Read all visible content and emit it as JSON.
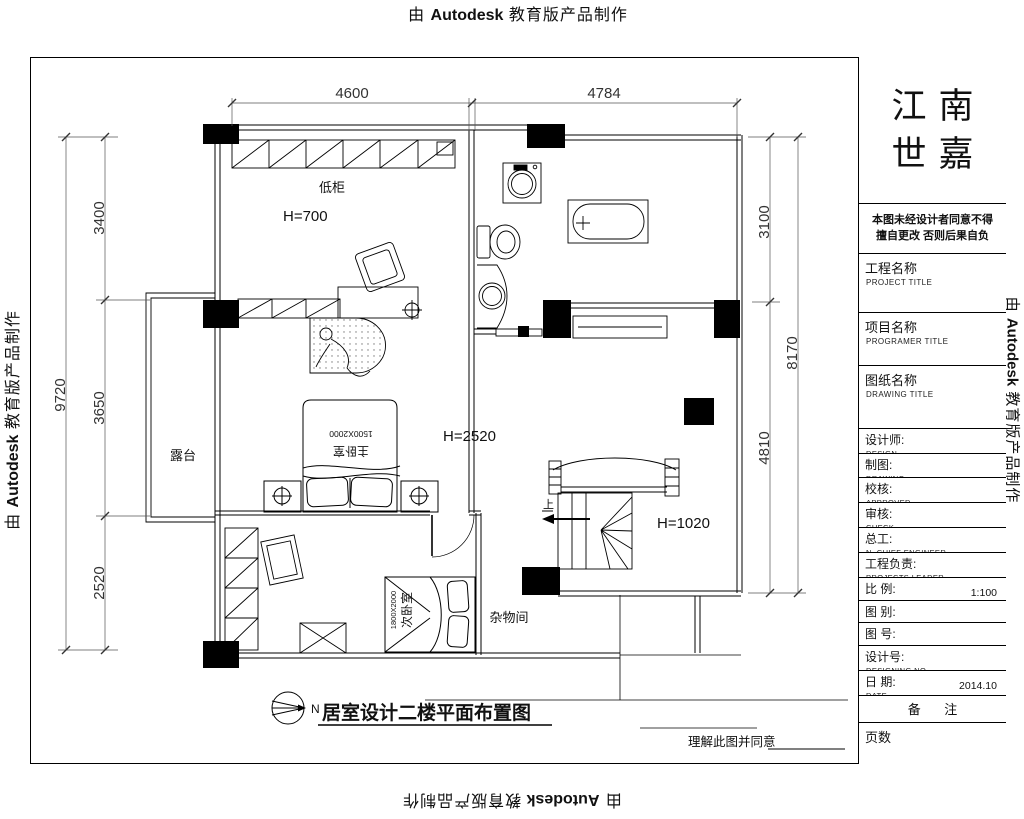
{
  "banner": {
    "prefix": "由",
    "brand": "Autodesk",
    "suffix": "教育版产品制作"
  },
  "title_block": {
    "brand_line1": "江南",
    "brand_line2": "世嘉",
    "note_line1": "本图未经设计者同意不得",
    "note_line2": "擅自更改 否则后果自负",
    "project": {
      "cn": "工程名称",
      "en": "PROJECT TITLE"
    },
    "program": {
      "cn": "项目名称",
      "en": "PROGRAMER TITLE"
    },
    "drawing_title": {
      "cn": "图纸名称",
      "en": "DRAWING TITLE"
    },
    "designer": {
      "cn": "设计师:",
      "en": "DESIGN"
    },
    "draughting": {
      "cn": "制图:",
      "en": "DRAWING"
    },
    "checker": {
      "cn": "校核:",
      "en": "APPROVED"
    },
    "auditor": {
      "cn": "审核:",
      "en": "CHECK"
    },
    "chief": {
      "cn": "总工:",
      "en": "N. CHIEF ENGINEER"
    },
    "leader": {
      "cn": "工程负责:",
      "en": "PROJECTS LEADER"
    },
    "scale": {
      "cn": "比 例:",
      "en": "SCLAE",
      "value": "1:100"
    },
    "style": {
      "cn": "图 别:",
      "en": "DRAWING STYLE"
    },
    "number": {
      "cn": "图 号:",
      "en": "DRAWING NO"
    },
    "design_no": {
      "cn": "设计号:",
      "en": "DESIGNING NO"
    },
    "date": {
      "cn": "日 期:",
      "en": "DATE",
      "value": "2014.10"
    },
    "remark": "备 注",
    "pages": "页数"
  },
  "plan": {
    "title": "居室设计二楼平面布置图",
    "north": "N",
    "agreement": "理解此图并同意",
    "labels": {
      "low_cabinet": "低柜",
      "h700": "H=700",
      "terrace": "露台",
      "master_bed": "主卧室",
      "master_bed_size": "1500X2000",
      "h2520": "H=2520",
      "second_bed": "次卧室",
      "second_bed_size": "1800X2000",
      "storage": "杂物间",
      "h1020": "H=1020",
      "up": "上"
    },
    "dims": {
      "top_left": "4600",
      "top_right": "4784",
      "left_total": "9720",
      "left_1": "3400",
      "left_2": "3650",
      "left_3": "2520",
      "right_total": "8170",
      "right_1": "3100",
      "right_2": "4810"
    }
  }
}
